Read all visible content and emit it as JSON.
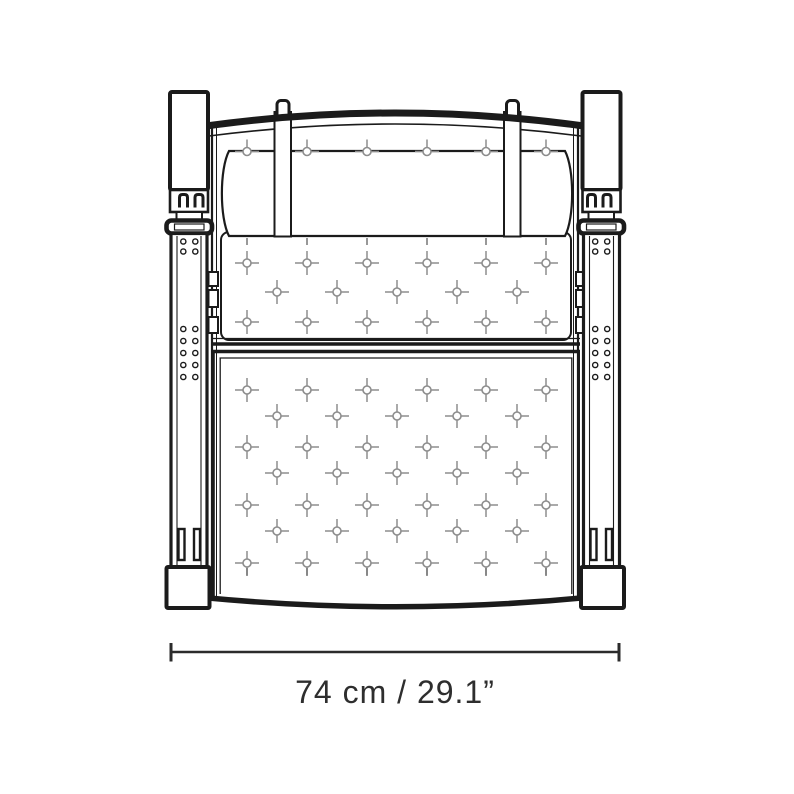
{
  "diagram": {
    "product": "lounge-chair-front-elevation",
    "dimension": {
      "label": "74 cm / 29.1”",
      "metric": "74 cm",
      "imperial": "29.1”"
    },
    "colors": {
      "outline": "#1b1b1b",
      "tuft": "#8d8d8d",
      "seam_tick": "#6d6d6d",
      "dimension_line": "#2b2b2b",
      "text": "#2e2e2e",
      "background": "#ffffff"
    },
    "tufting": {
      "headrest_button_count": 6,
      "back_row_counts": [
        6,
        5,
        6
      ],
      "seat_row_counts": [
        6,
        5,
        6,
        5,
        6,
        5,
        6
      ],
      "seam_tick_count": 6
    },
    "strap": {
      "hole_columns": 2,
      "top_hole_rows": 2,
      "mid_hole_rows": 5,
      "bottom_slot_count": 2
    }
  }
}
